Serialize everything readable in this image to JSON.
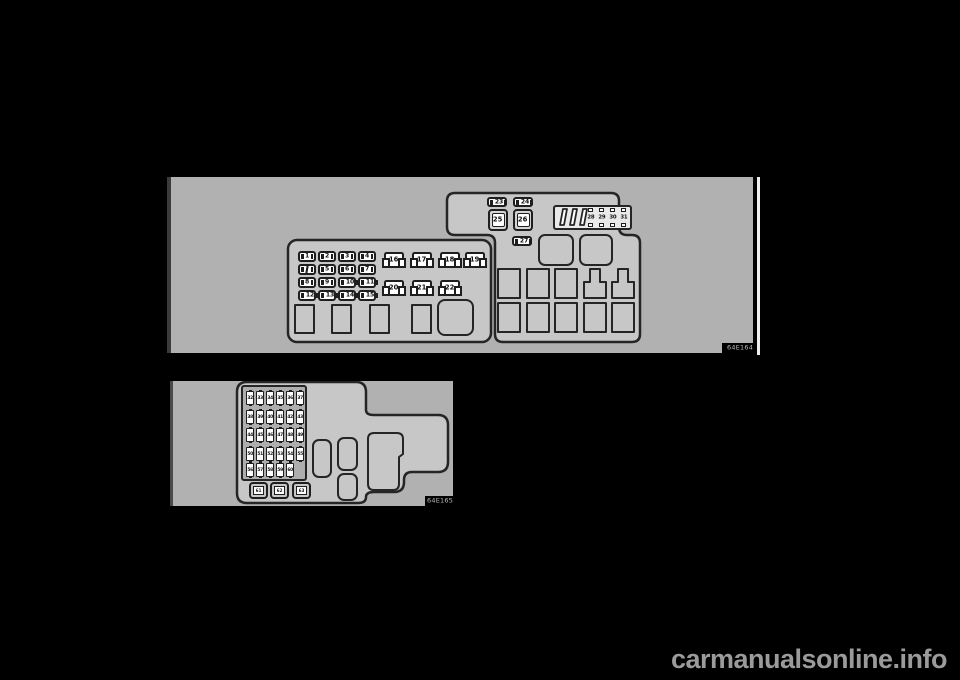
{
  "colors": {
    "page_bg": "#000000",
    "panel_bg": "#b1b1b1",
    "fusebox_fill": "#c7c7c7",
    "outline": "#1e1e1e",
    "inner_panel": "#aeaeae",
    "label_bg": "#000000",
    "label_fg": "#bdbdbd",
    "watermark_fg": "#9b9b9b"
  },
  "top_diagram": {
    "figure_label": "64E164",
    "mini_fuse_rows": [
      [
        "1",
        "2",
        "3",
        "4"
      ],
      [
        "",
        "5",
        "6",
        "7"
      ],
      [
        "8",
        "9",
        "10",
        "11"
      ],
      [
        "12",
        "13",
        "14",
        "15"
      ]
    ],
    "medium_fuses": [
      "16",
      "17",
      "18",
      "19",
      "20",
      "21",
      "22"
    ],
    "relay_fuses_top": [
      "23",
      "24"
    ],
    "square_fuses": [
      "25",
      "26"
    ],
    "relay_fuse_bottom": [
      "27"
    ],
    "strip_fuses": [
      "28",
      "29",
      "30",
      "31"
    ]
  },
  "bottom_diagram": {
    "figure_label": "64E165",
    "grid_rows": [
      [
        "32",
        "33",
        "34",
        "35",
        "36",
        "37"
      ],
      [
        "38",
        "39",
        "40",
        "41",
        "42",
        "43"
      ],
      [
        "44",
        "45",
        "46",
        "47",
        "48",
        "49"
      ],
      [
        "50",
        "51",
        "52",
        "53",
        "54",
        "55"
      ],
      [
        "56",
        "57",
        "58",
        "59",
        "60"
      ]
    ],
    "square_fuses": [
      "61",
      "62",
      "63"
    ]
  },
  "watermark": "carmanualsonline.info"
}
